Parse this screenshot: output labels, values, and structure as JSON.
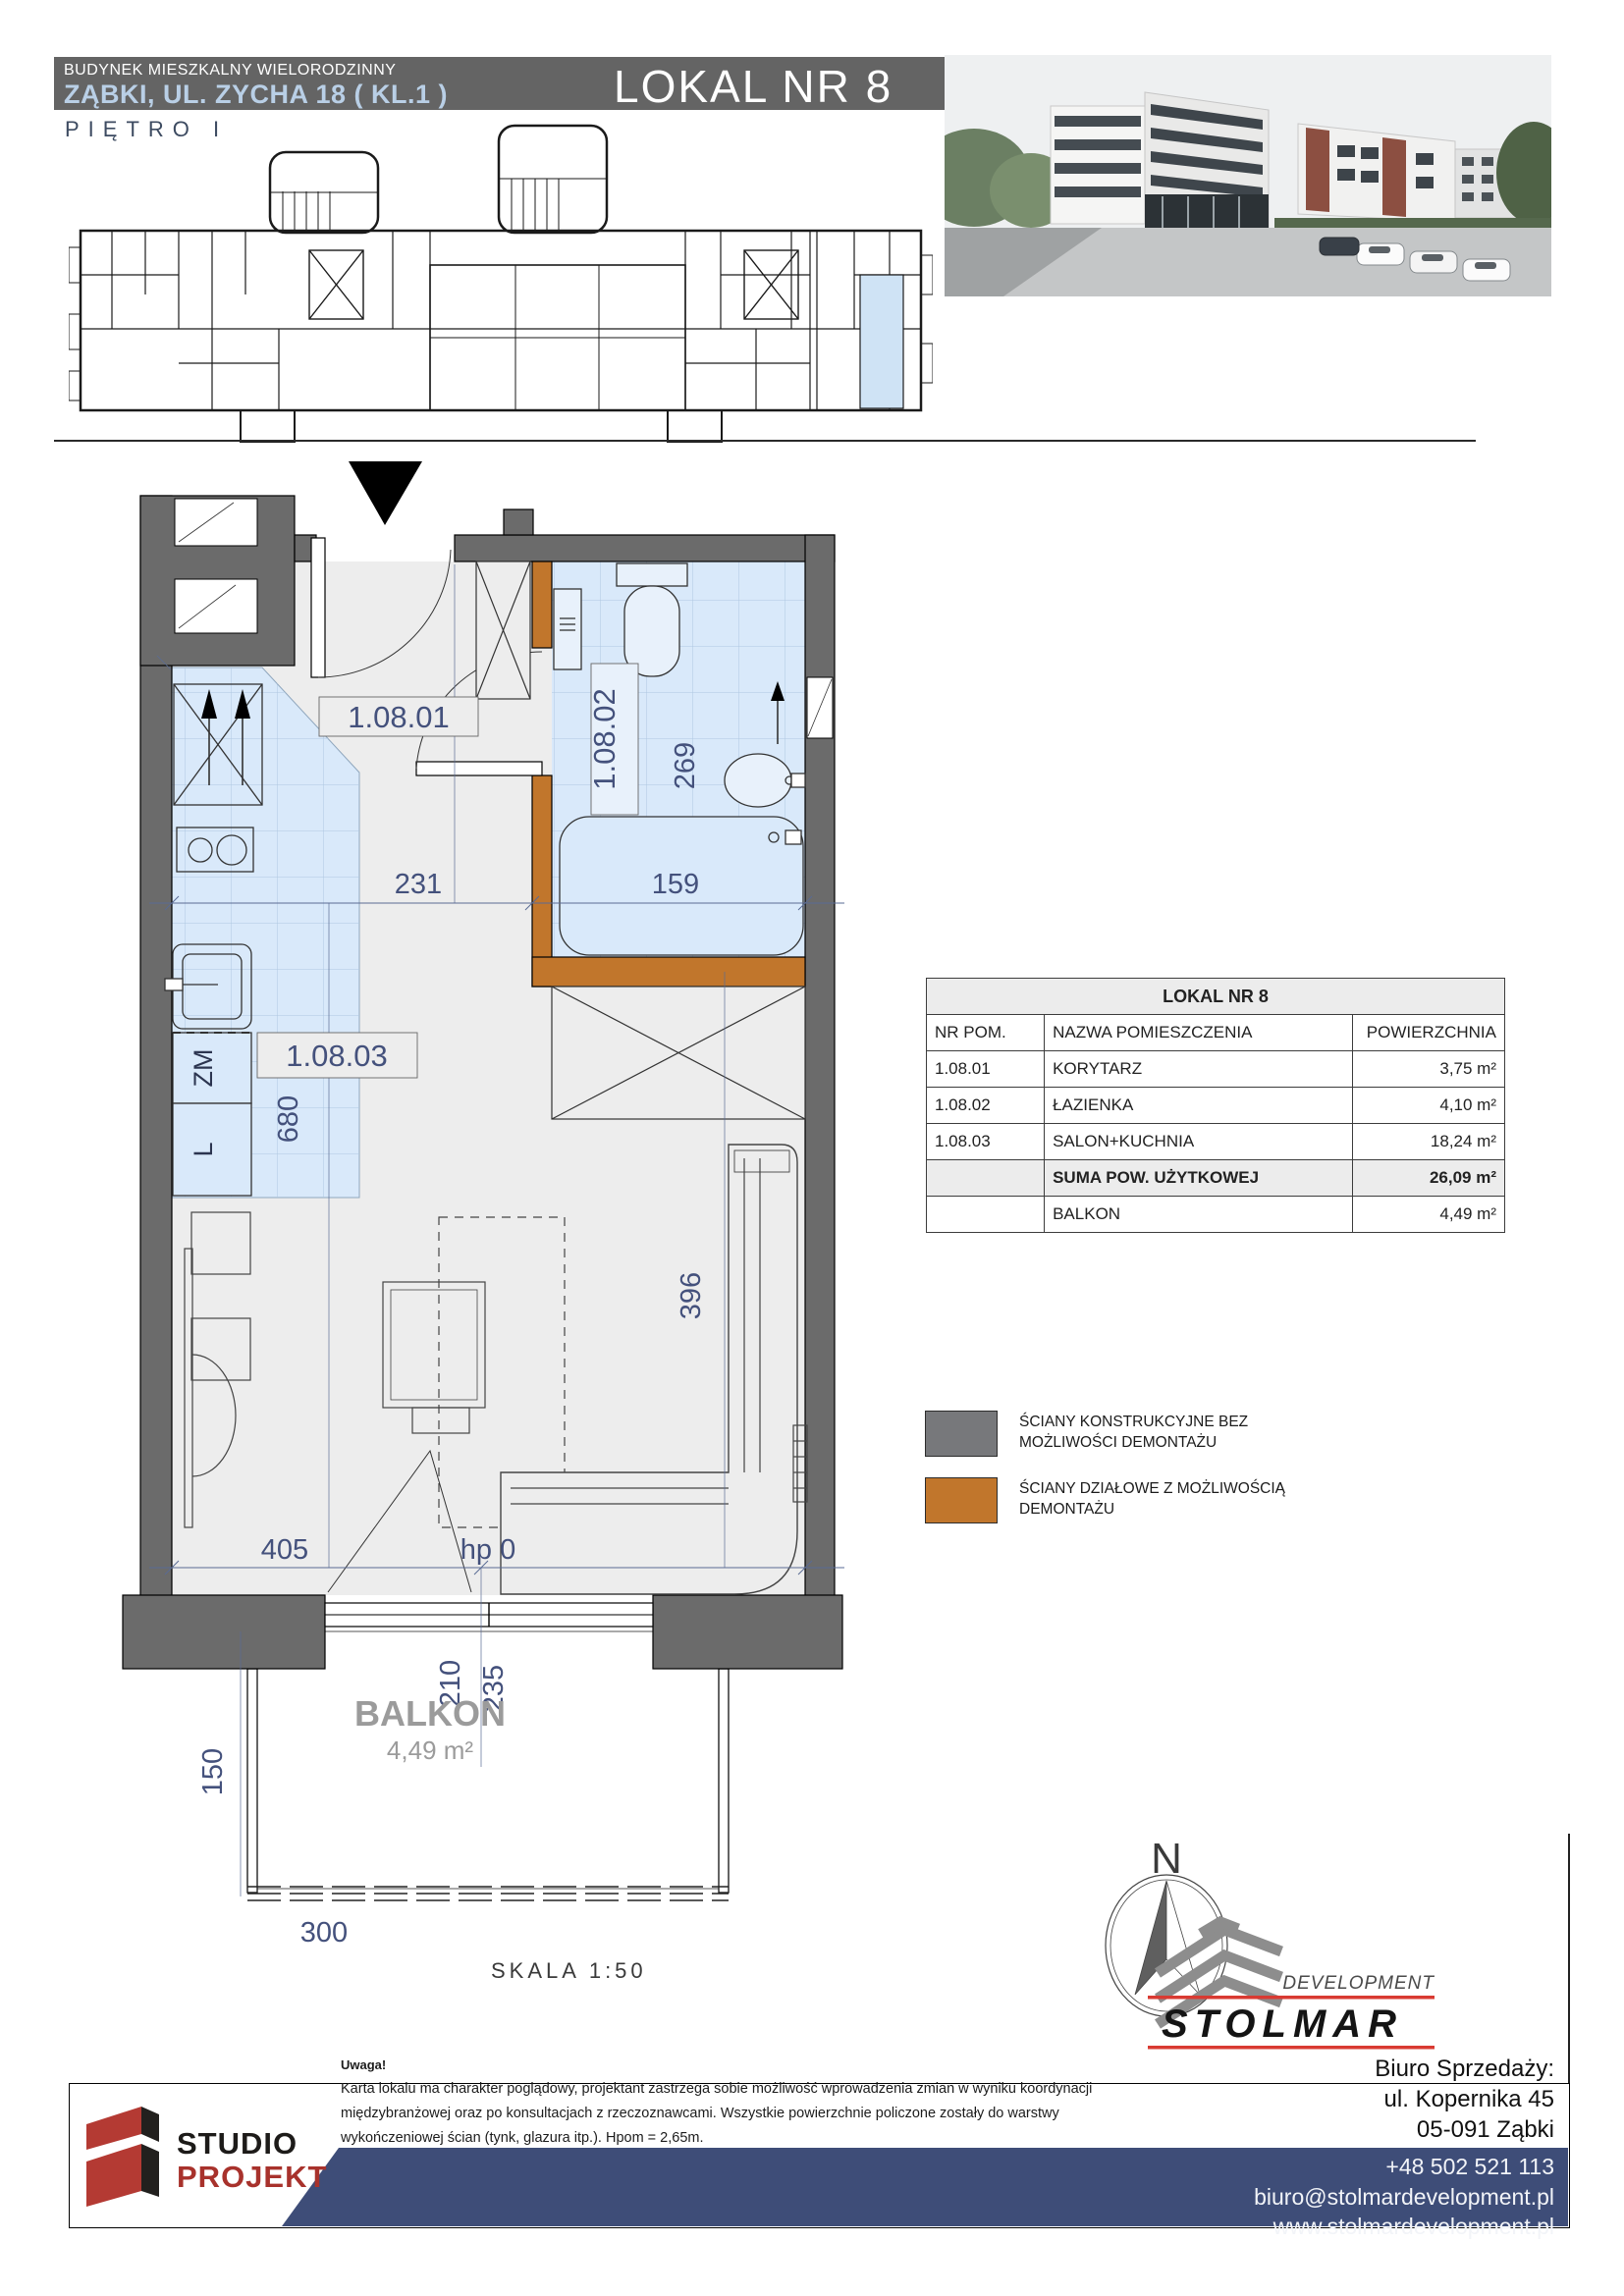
{
  "header": {
    "building_type": "BUDYNEK MIESZKALNY WIELORODZINNY",
    "address": "ZĄBKI, UL. ZYCHA 18 ( KL.1 )",
    "unit_title": "LOKAL NR 8",
    "floor_label": "PIĘTRO I"
  },
  "plan": {
    "rooms": {
      "hall": "1.08.01",
      "bath": "1.08.02",
      "salon": "1.08.03"
    },
    "dims": {
      "hall_width": "231",
      "bath_width": "159",
      "bath_depth": "269",
      "kitchen_depth": "680",
      "salon_depth": "396",
      "salon_width": "405",
      "sill": "hp 0",
      "balcony_d1": "210",
      "balcony_d2": "235",
      "balcony_depth": "150",
      "balcony_width": "300"
    },
    "kitchen": {
      "dishwasher": "ZM",
      "fridge": "L"
    },
    "balcony_label": "BALKON",
    "balcony_area": "4,49 m²",
    "scale_label": "SKALA 1:50",
    "north": "N"
  },
  "table": {
    "title": "LOKAL NR 8",
    "headers": {
      "nr": "NR POM.",
      "name": "NAZWA POMIESZCZENIA",
      "area": "POWIERZCHNIA"
    },
    "rows": [
      {
        "nr": "1.08.01",
        "name": "KORYTARZ",
        "area": "3,75 m²"
      },
      {
        "nr": "1.08.02",
        "name": "ŁAZIENKA",
        "area": "4,10 m²"
      },
      {
        "nr": "1.08.03",
        "name": "SALON+KUCHNIA",
        "area": "18,24 m²"
      }
    ],
    "suma": {
      "name": "SUMA POW. UŻYTKOWEJ",
      "area": "26,09 m²"
    },
    "balkon": {
      "name": "BALKON",
      "area": "4,49 m²"
    }
  },
  "legend": {
    "structural": "ŚCIANY KONSTRUKCYJNE BEZ MOŻLIWOŚCI DEMONTAŻU",
    "partition": "ŚCIANY DZIAŁOWE Z MOŻLIWOŚCIĄ DEMONTAŻU"
  },
  "colors": {
    "structural_wall": "#6b6b6b",
    "partition_wall": "#c1762c",
    "wet_floor": "#d9e9fa",
    "navy_text": "#44517c",
    "footer_band": "#3e4d78",
    "brand_red": "#b43a33"
  },
  "branding": {
    "studio_line1": "STUDIO",
    "studio_line2": "PROJEKT",
    "development": "DEVELOPMENT",
    "stolmar": "STOLMAR"
  },
  "footer": {
    "uwaga": "Uwaga!",
    "disclaimer1": "Karta lokalu ma charakter poglądowy, projektant zastrzega sobie możliwość wprowadzenia zmian w wyniku koordynacji",
    "disclaimer2": "międzybranżowej oraz po konsultacjach z rzeczoznawcami. Wszystkie powierzchnie policzone zostały do warstwy",
    "disclaimer3": "wykończeniowej ścian (tynk, glazura itp.). Hpom = 2,65m.",
    "office1": "Biuro Sprzedaży:",
    "office2": "ul. Kopernika 45",
    "office3": "05-091 Ząbki",
    "phone": "+48 502 521 113",
    "email": "biuro@stolmardevelopment.pl",
    "www": "www.stolmardevelopment.pl"
  }
}
